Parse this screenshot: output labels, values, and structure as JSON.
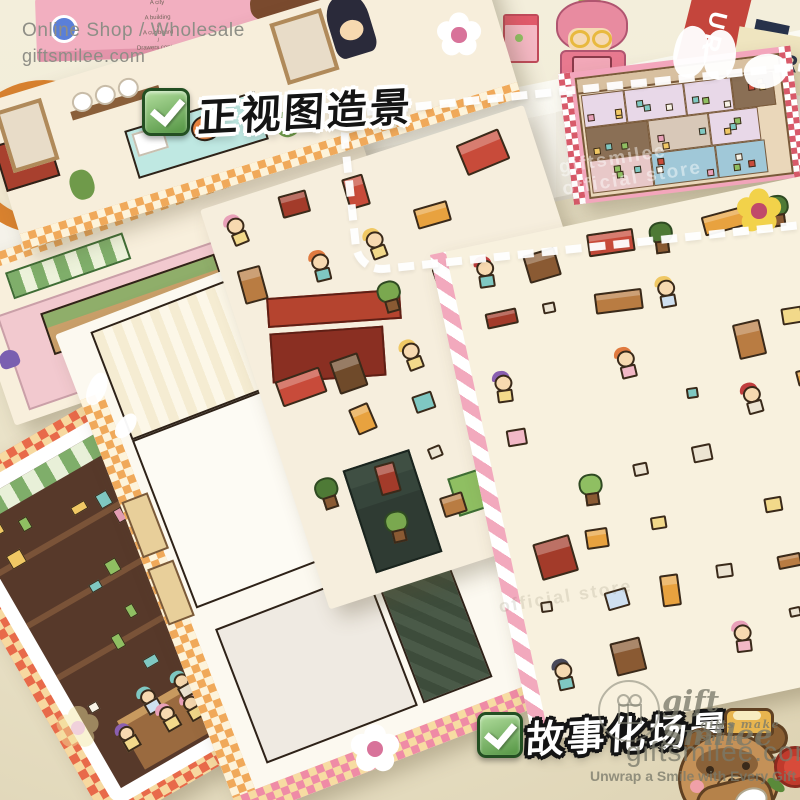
{
  "header": {
    "shop_line": "Online Shop / Wholesale",
    "site_line": "giftsmilee.com"
  },
  "shelf_note": {
    "lines": [
      "A city",
      "/",
      "A building",
      "/",
      "A cupboard",
      "/",
      "Drawers contain",
      "WHAT"
    ]
  },
  "products": {
    "new_badge": "NEW",
    "book_red_letters": "UR",
    "book_cream_letter": "R"
  },
  "badges": {
    "top_label": "正视图造景",
    "bottom_label": "故事化场景"
  },
  "watermark": {
    "brand": "gift Smilee",
    "brand_sub": "gifts make smile",
    "site": "giftsmilee.com",
    "tagline": "Unwrap a Smile with Every Gift",
    "diag_line1": "giftsmilee",
    "diag_line2": "official store"
  },
  "colors": {
    "desk": "#e7dfc4",
    "shelf_white": "#f8f6ef",
    "badge_green": "#5d9c4c",
    "card_pink": "#f3a6bc",
    "checker_orange": "#f0a95a",
    "checker_pink": "#ef8ba6",
    "watermark_gray": "#7a7a6a",
    "bear_brown": "#c49158",
    "rose_red": "#d84b3a"
  },
  "decor": {
    "palette_furniture": [
      "#8a5a33",
      "#b97c42",
      "#6f4a2a",
      "#a33b2a",
      "#c84b3a",
      "#e8a23f"
    ],
    "palette_soft": [
      "#f2d98a",
      "#f2b8c6",
      "#7fc8c2",
      "#ece4d2",
      "#cfe0f0"
    ],
    "palette_plant": [
      "#7aa84f",
      "#4e7a36",
      "#8fbf62"
    ],
    "palette_hair": [
      "#8a5fb0",
      "#e07a3f",
      "#c03d3d",
      "#f0c864",
      "#4a4a5a",
      "#e8a0b8",
      "#7fc8c2"
    ],
    "palette_rooms": [
      "#c9b8a0",
      "#8a6f55",
      "#d8c8b8",
      "#b5d8c8",
      "#e8d8e8",
      "#a0c8d8",
      "#d8b5a0",
      "#c8d8a0",
      "#e8c8c8"
    ],
    "palette_shop": [
      "#e8a0b8",
      "#7fc8c2",
      "#f0c864",
      "#c84b3a",
      "#8fbf62",
      "#f7f3e6"
    ],
    "skin": "#f7d9b0",
    "outline": "#3a2a1a"
  }
}
